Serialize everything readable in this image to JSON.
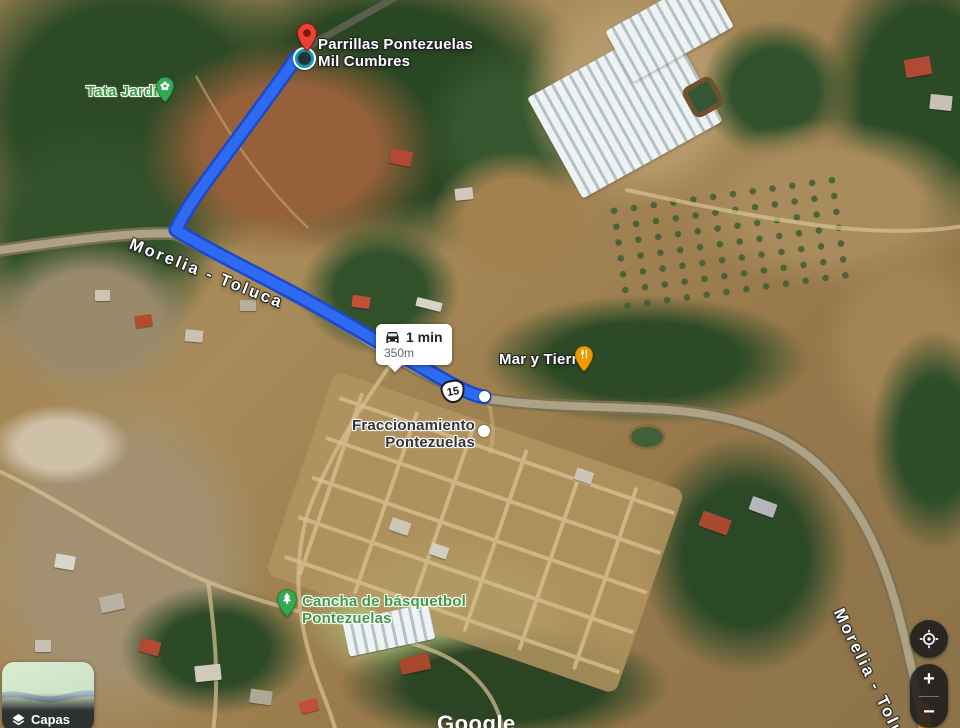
{
  "map_app": {
    "watermark": "Google"
  },
  "route": {
    "duration": "1 min",
    "distance": "350m",
    "shield": "15"
  },
  "roads": {
    "main_label": "Morelia - Toluca"
  },
  "pois": {
    "destination_line1": "Parrillas Pontezuelas",
    "destination_line2": "Mil Cumbres",
    "tata_jardin": "Tata Jardín",
    "mar_y_tierra": "Mar y Tierra",
    "fraccionamiento_line1": "Fraccionamiento",
    "fraccionamiento_line2": "Pontezuelas",
    "cancha_line1": "Cancha de básquetbol",
    "cancha_line2": "Pontezuelas"
  },
  "controls": {
    "layers_label": "Capas",
    "zoom_in_label": "+",
    "zoom_out_label": "−"
  },
  "colors": {
    "route": "#2e6bf2",
    "route_casing": "#1c49c9",
    "pin_red": "#ea4335",
    "poi_green": "#34a853",
    "poi_orange": "#f29900",
    "label_green": "#3f9b43"
  },
  "icons": {
    "car": "car-icon",
    "layers": "layers-icon",
    "my_location": "my-location-icon",
    "zoom_in": "plus-icon",
    "zoom_out": "minus-icon",
    "pegman": "pegman-icon",
    "destination_pin": "destination-pin-icon",
    "park_pin": "park-pin-icon",
    "restaurant_pin": "restaurant-pin-icon",
    "tree_pin": "tree-pin-icon",
    "poi_dot": "poi-dot",
    "mil_cumbres_badge": "mil-cumbres-badge"
  }
}
